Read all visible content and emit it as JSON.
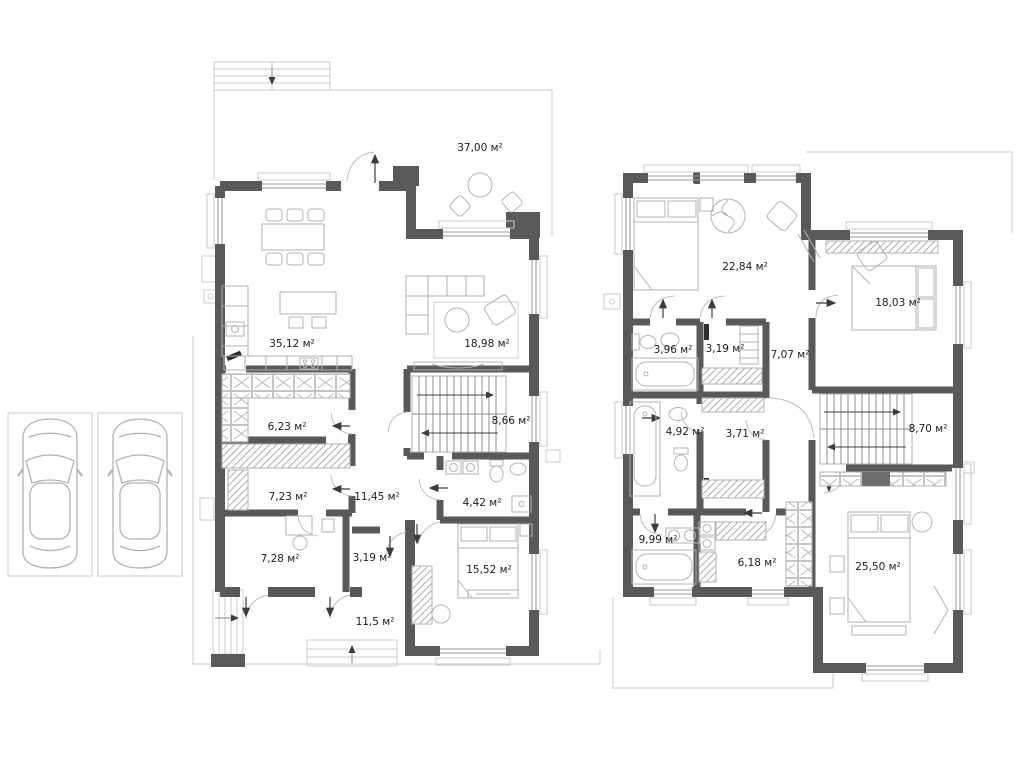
{
  "colors": {
    "wall": "#59595b",
    "furniture_line": "#b3b3b3",
    "site_outline": "#cbcbcb",
    "label_text": "#1c1c1c",
    "arrow": "#3c3c3c"
  },
  "floors": [
    {
      "id": "first-floor",
      "rooms": [
        {
          "area": "37,00 м²"
        },
        {
          "area": "35,12 м²"
        },
        {
          "area": "18,98 м²"
        },
        {
          "area": "6,23 м²"
        },
        {
          "area": "8,66 м²"
        },
        {
          "area": "7,23 м²"
        },
        {
          "area": "11,45 м²"
        },
        {
          "area": "4,42 м²"
        },
        {
          "area": "7,28 м²"
        },
        {
          "area": "3,19 м²"
        },
        {
          "area": "15,52 м²"
        },
        {
          "area": "11,5 м²"
        }
      ]
    },
    {
      "id": "second-floor",
      "rooms": [
        {
          "area": "22,84 м²"
        },
        {
          "area": "18,03 м²"
        },
        {
          "area": "3,96 м²"
        },
        {
          "area": "3,19 м²"
        },
        {
          "area": "7,07 м²"
        },
        {
          "area": "4,92 м²"
        },
        {
          "area": "3,71 м²"
        },
        {
          "area": "8,70 м²"
        },
        {
          "area": "9,99 м²"
        },
        {
          "area": "6,18 м²"
        },
        {
          "area": "25,50 м²"
        }
      ]
    }
  ]
}
